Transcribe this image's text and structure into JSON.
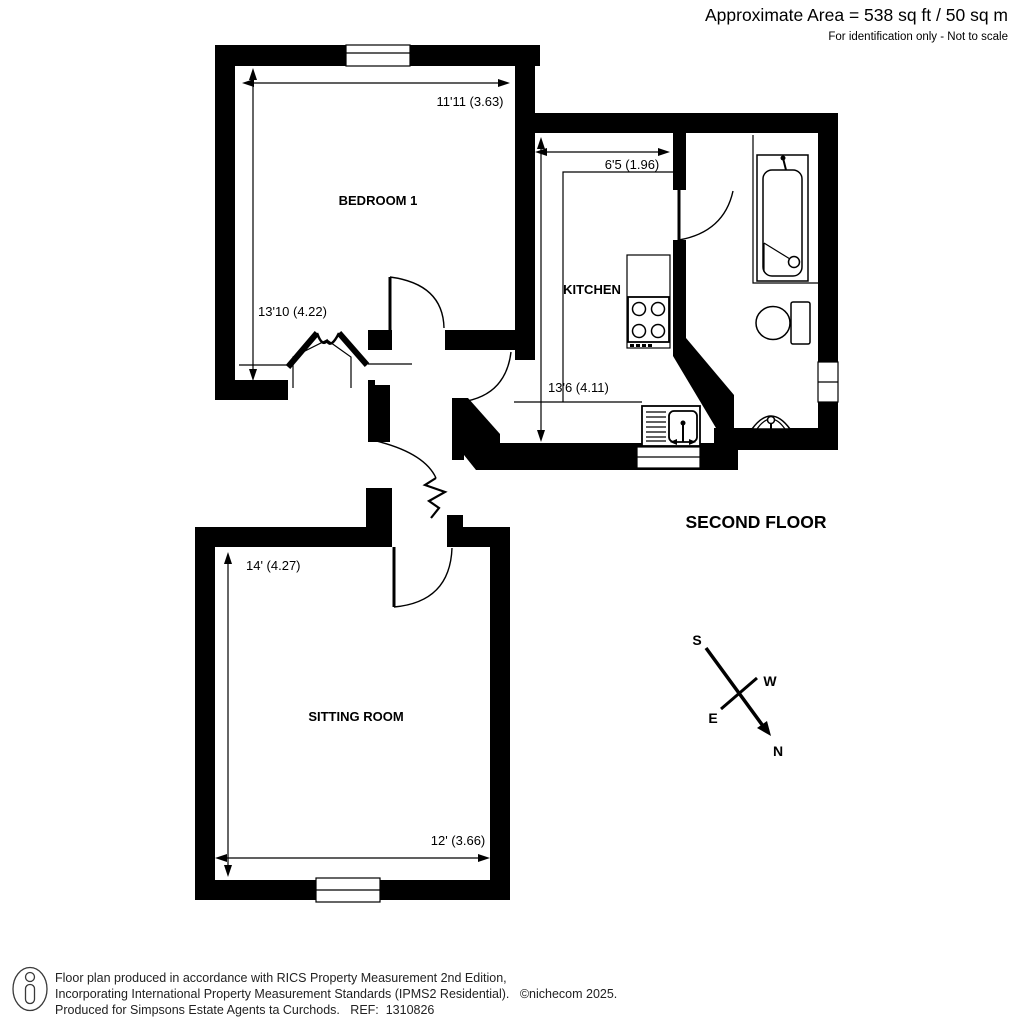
{
  "header": {
    "area_label": "Approximate Area = 538 sq ft / 50 sq m",
    "disclaimer": "For identification only - Not to scale"
  },
  "plan": {
    "floor_label": "SECOND FLOOR",
    "rooms": {
      "bedroom": {
        "name": "BEDROOM 1",
        "width": "11'11 (3.63)",
        "depth": "13'10 (4.22)"
      },
      "kitchen": {
        "name": "KITCHEN",
        "width": "6'5 (1.96)",
        "depth": "13'6 (4.11)"
      },
      "sitting_room": {
        "name": "SITTING ROOM",
        "width": "12' (3.66)",
        "depth": "14' (4.27)"
      }
    },
    "compass": {
      "north": "N",
      "south": "S",
      "east": "E",
      "west": "W"
    }
  },
  "footer": {
    "line1": "Floor plan produced in accordance with RICS Property Measurement 2nd Edition,",
    "line2": "Incorporating International Property Measurement Standards (IPMS2 Residential).   ©nichecom 2025.",
    "line3": "Produced for Simpsons Estate Agents ta Curchods.   REF:  1310826"
  },
  "colors": {
    "wall": "#000000",
    "background": "#ffffff",
    "text": "#000000"
  }
}
